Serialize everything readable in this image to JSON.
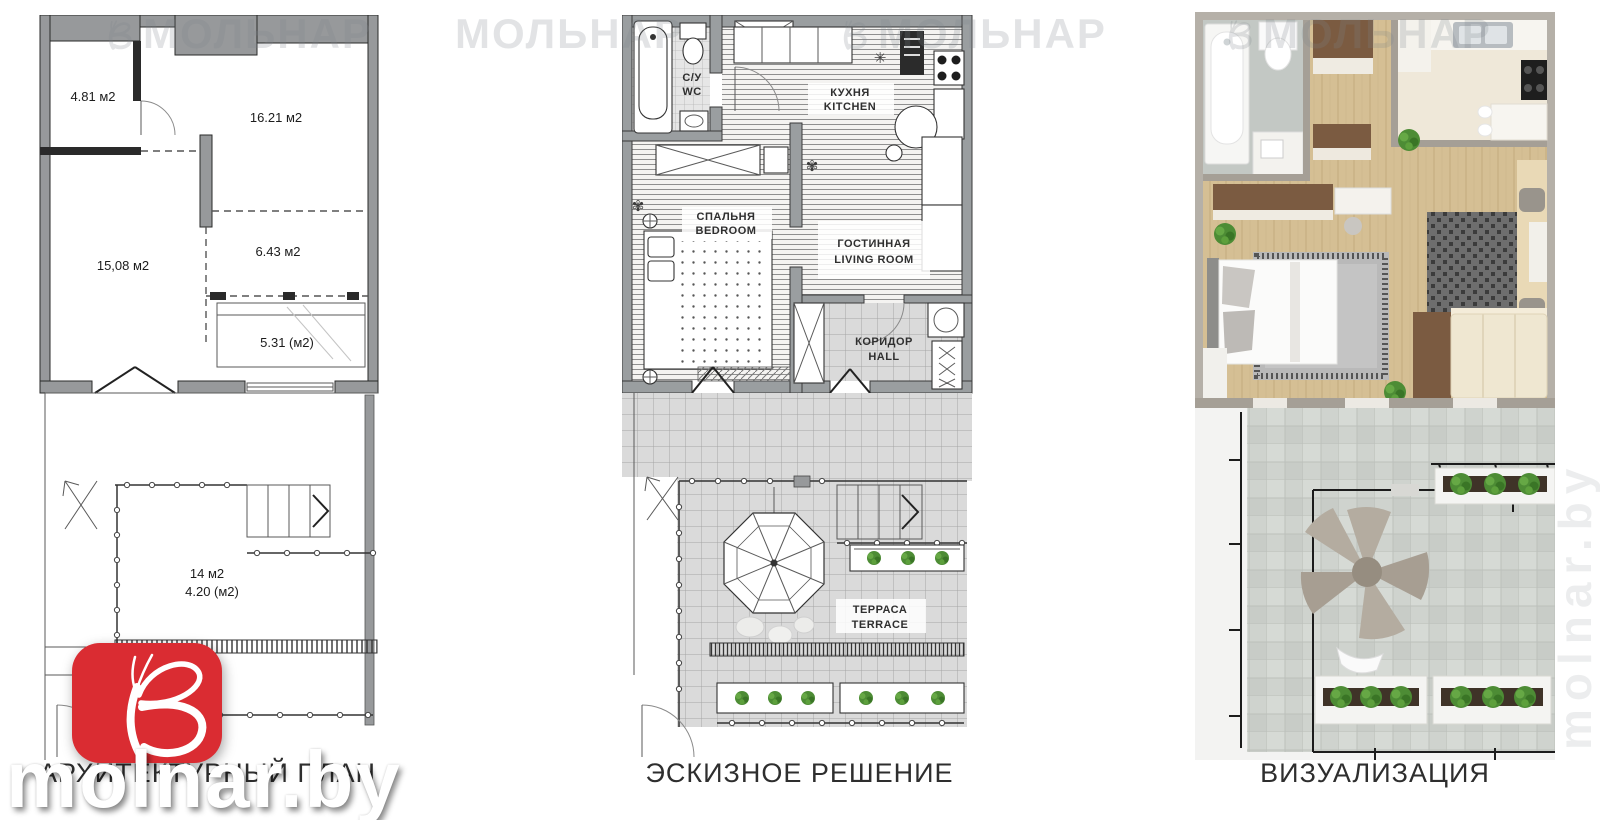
{
  "captions": {
    "architectural": "АРХИТЕКТУРНЫЙ ПЛАН",
    "sketch": "ЭСКИЗНОЕ РЕШЕНИЕ",
    "visualization": "ВИЗУАЛИЗАЦИЯ"
  },
  "architectural_plan": {
    "areas": {
      "a481": "4.81 м2",
      "a1621": "16.21 м2",
      "a1508": "15,08 м2",
      "a643": "6.43 м2",
      "a531": "5.31 (м2)",
      "a14": "14 м2",
      "a420": "4.20 (м2)"
    }
  },
  "sketch_plan": {
    "rooms": {
      "wc_ru": "С/У",
      "wc_en": "WC",
      "kitchen_ru": "КУХНЯ",
      "kitchen_en": "KITCHEN",
      "bedroom_ru": "СПАЛЬНЯ",
      "bedroom_en": "BEDROOM",
      "living_ru": "ГОСТИННАЯ",
      "living_en": "LIVING ROOM",
      "hall_ru": "КОРИДОР",
      "hall_en": "HALL",
      "terrace_ru": "ТЕРРАСА",
      "terrace_en": "TERRACE"
    }
  },
  "watermarks": {
    "brand": "МОЛЬНАР",
    "site": "molnar.by",
    "side": "molnar.by"
  },
  "colors": {
    "logo_red": "#da2c32",
    "wall_gray": "#97999b",
    "wood_floor": "#d5bf94",
    "stone_tile": "#cfd3ce",
    "plant_green": "#4d8c35",
    "caption_text": "#2e2e2e",
    "watermark_gray": "#7d858b"
  }
}
